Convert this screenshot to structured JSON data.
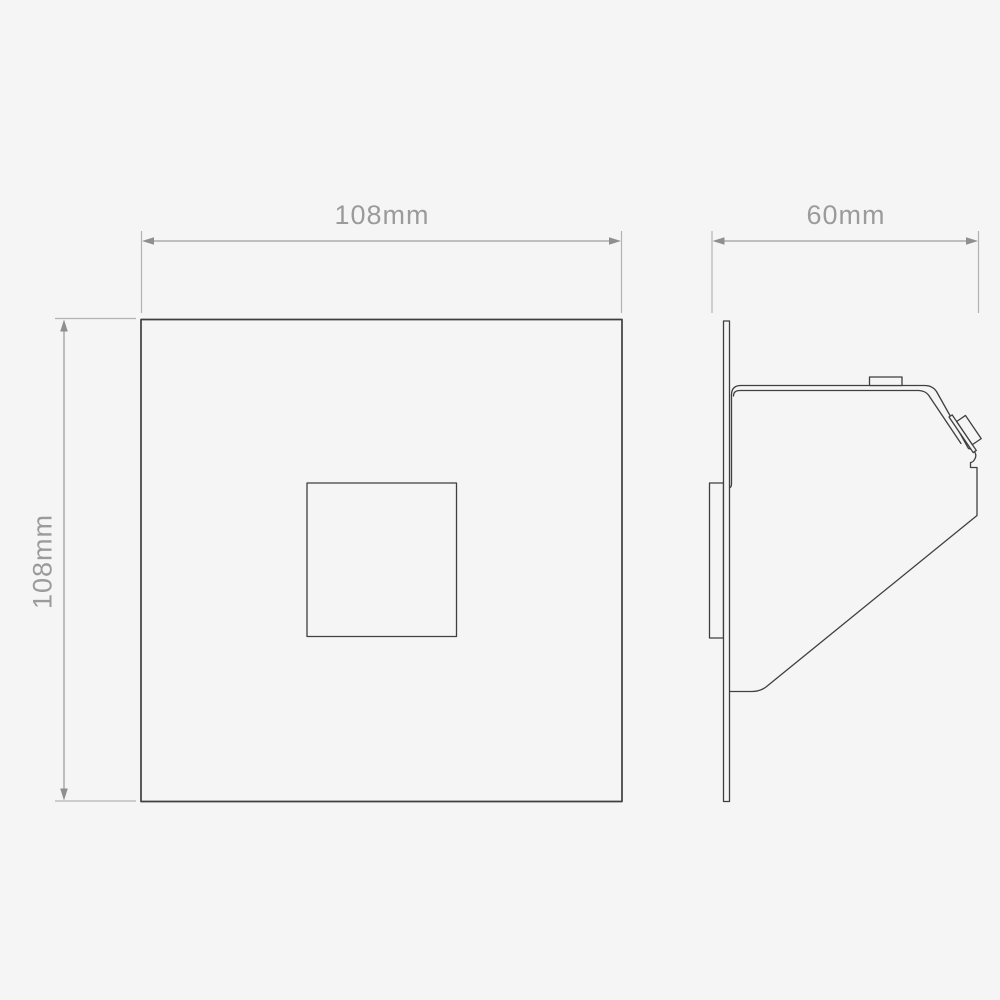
{
  "page": {
    "background_color": "#f5f5f5"
  },
  "drawing": {
    "type": "technical-dimension-drawing",
    "subject": "square recessed wall light, front elevation and side profile",
    "views": {
      "front": {
        "name": "front-view",
        "width_dimension": "108mm",
        "height_dimension": "108mm"
      },
      "side": {
        "name": "side-profile-view",
        "depth_dimension": "60mm"
      }
    },
    "colors": {
      "background": "#f5f5f5",
      "outline": "#3f3f3f",
      "dimension_line": "#9e9e9e",
      "dimension_text": "#9b9b9b"
    }
  }
}
